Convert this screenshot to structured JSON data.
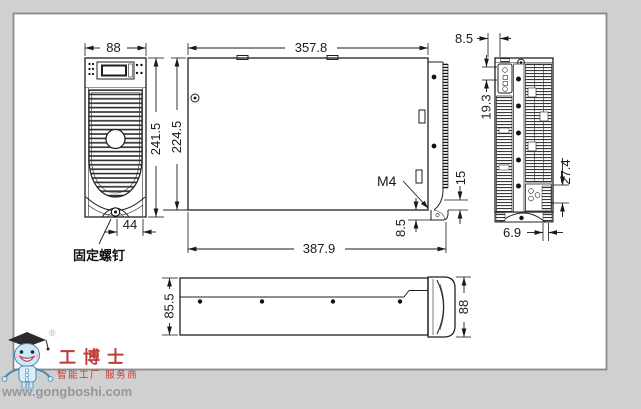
{
  "style": {
    "page_bg": "#d0d0d0",
    "sheet_bg": "#ffffff",
    "sheet_border": "#8a8a8a",
    "line_color": "#1a1a1a"
  },
  "front_view": {
    "dim_width": "88",
    "dim_height": "241.5",
    "dim_base": "44",
    "note_fixing_screw": "固定螺钉"
  },
  "side_view": {
    "dim_top_length": "357.8",
    "dim_height": "224.5",
    "dim_total_length": "387.9",
    "label_screw_spec": "M4",
    "dim_foot": "8.5",
    "dim_edge": "15"
  },
  "rear_view": {
    "dim_top": "8.5",
    "dim_connector": "19.3",
    "dim_terminal": "27.4",
    "dim_bottom": "6.9"
  },
  "bottom_view": {
    "dim_depth": "85.5",
    "dim_width": "88"
  },
  "watermark": {
    "registered_mark": "®",
    "brand": "工博士",
    "tagline": "智能工厂 服务商",
    "website": "www.gongboshi.com",
    "brand_color": "#c23b34",
    "website_color": "#97979b"
  }
}
